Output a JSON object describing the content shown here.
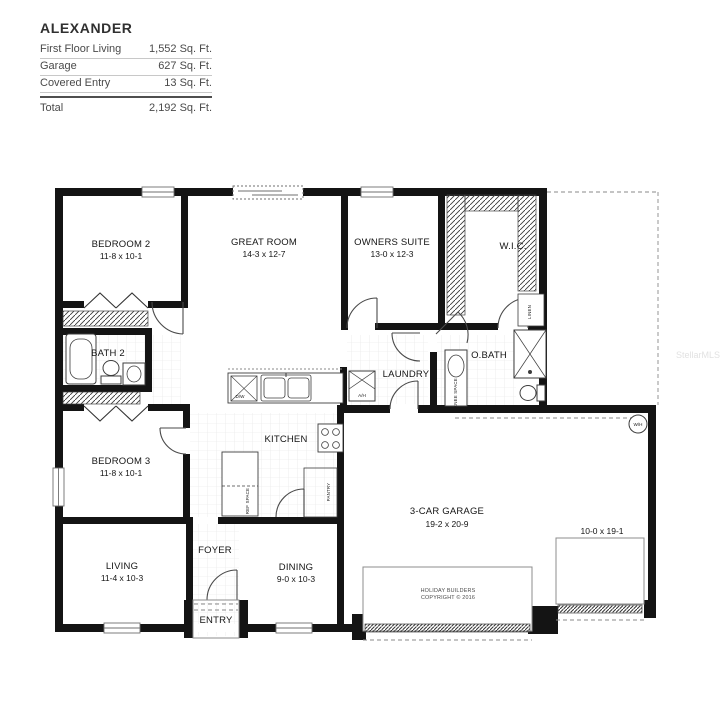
{
  "header": {
    "title": "ALEXANDER",
    "rows": [
      {
        "label": "First Floor Living",
        "value": "1,552 Sq. Ft."
      },
      {
        "label": "Garage",
        "value": "627 Sq. Ft."
      },
      {
        "label": "Covered Entry",
        "value": "13 Sq. Ft."
      }
    ],
    "total_label": "Total",
    "total_value": "2,192 Sq. Ft."
  },
  "watermark": "StellarMLS",
  "plan": {
    "rooms": {
      "bedroom2": {
        "name": "BEDROOM 2",
        "dims": "11-8 x 10-1"
      },
      "great_room": {
        "name": "GREAT ROOM",
        "dims": "14-3 x 12-7"
      },
      "owners_suite": {
        "name": "OWNERS SUITE",
        "dims": "13-0 x 12-3"
      },
      "wic": {
        "name": "W.I.C."
      },
      "bath2": {
        "name": "BATH 2"
      },
      "laundry": {
        "name": "LAUNDRY"
      },
      "obath": {
        "name": "O.BATH"
      },
      "bedroom3": {
        "name": "BEDROOM 3",
        "dims": "11-8 x 10-1"
      },
      "kitchen": {
        "name": "KITCHEN"
      },
      "living": {
        "name": "LIVING",
        "dims": "11-4 x 10-3"
      },
      "foyer": {
        "name": "FOYER"
      },
      "dining": {
        "name": "DINING",
        "dims": "9-0 x 10-3"
      },
      "entry": {
        "name": "ENTRY"
      },
      "garage": {
        "name": "3-CAR GARAGE",
        "dims": "19-2 x 20-9"
      },
      "garage_bay": {
        "dims": "10-0 x 19-1"
      }
    },
    "fixtures": {
      "linen": "LINEN",
      "knee_space": "KNEE SPACE",
      "ref_space": "REF SPACE",
      "pantry": "PANTRY",
      "dishwasher": "D/W",
      "air_handler": "A/H",
      "water_heater": "W/H"
    },
    "copyright": {
      "line1": "HOLIDAY BUILDERS",
      "line2": "COPYRIGHT © 2016"
    }
  }
}
